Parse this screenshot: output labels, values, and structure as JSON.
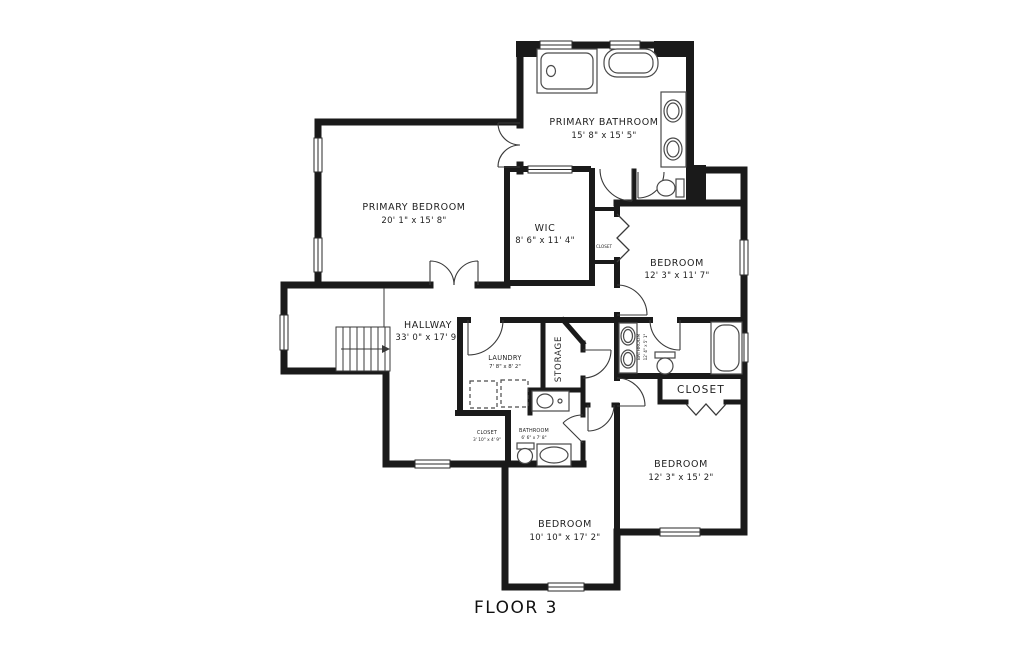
{
  "floor_title": "FLOOR 3",
  "colors": {
    "wall": "#1a1a1a",
    "fixture_line": "#4a4a4a",
    "door_line": "#3a3a3a",
    "text": "#1f1f1f",
    "background": "#ffffff"
  },
  "rooms": {
    "primary_bathroom": {
      "name": "PRIMARY BATHROOM",
      "dims": "15' 8\" x 15' 5\""
    },
    "primary_bedroom": {
      "name": "PRIMARY BEDROOM",
      "dims": "20' 1\" x 15' 8\""
    },
    "wic": {
      "name": "WIC",
      "dims": "8' 6\" x 11' 4\""
    },
    "bedroom_top_right": {
      "name": "BEDROOM",
      "dims": "12' 3\" x 11' 7\""
    },
    "hallway": {
      "name": "HALLWAY",
      "dims": "33' 0\" x 17' 9\""
    },
    "laundry": {
      "name": "LAUNDRY",
      "dims": "7' 8\" x 8' 2\""
    },
    "storage": {
      "name": "STORAGE"
    },
    "bathroom_middle": {
      "name": "BATHROOM",
      "dims": "12' 4\" x 5' 1\""
    },
    "closet_right": {
      "name": "CLOSET"
    },
    "closet_niche": {
      "name": "CLOSET"
    },
    "closet_small": {
      "name": "CLOSET",
      "dims": "3' 10\" x 4' 9\""
    },
    "bathroom_small": {
      "name": "BATHROOM",
      "dims": "6' 6\" x 7' 8\""
    },
    "bedroom_bottom": {
      "name": "BEDROOM",
      "dims": "10' 10\" x 17' 2\""
    },
    "bedroom_bottom_right": {
      "name": "BEDROOM",
      "dims": "12' 3\" x 15' 2\""
    }
  }
}
